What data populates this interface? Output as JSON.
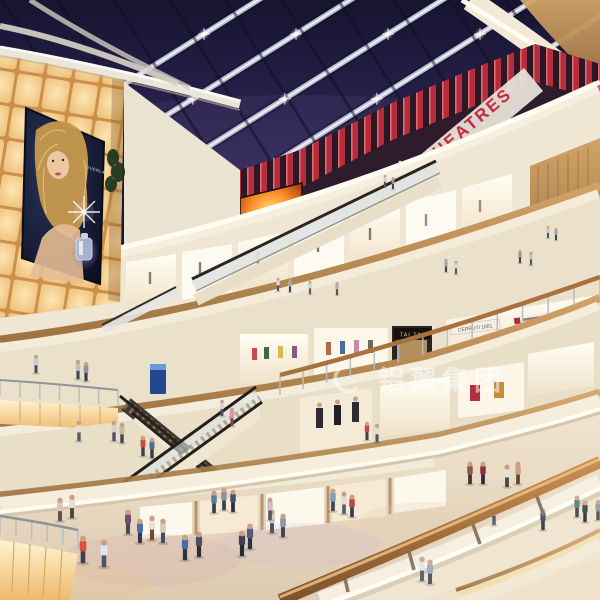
{
  "scene": {
    "description": "Night-time interior rendering of a multi-level shopping mall atrium with glass skylight, curved balconies, escalators and shoppers",
    "signs": {
      "theatres": "THEATRES",
      "tai_tai": "TAI TAI",
      "boutique": "CERRUTI 1881",
      "billboard_brand": "GUERLAIN"
    },
    "watermark": {
      "text": "铝翼集团"
    },
    "colors": {
      "sky": "#251f49",
      "beam": "#c9cde0",
      "red_slat": "#b5293a",
      "theatre_red": "#c4293c",
      "fascia_cream": "#f5eedd",
      "wood": "#c49a62",
      "glow_wall": "#f4cf92",
      "floor": "#e9dcc4",
      "fire_screen": "#ff8c2a",
      "rail_wood": "#b0793f",
      "watermark_white": "#ffffff"
    },
    "people": [
      [
        83,
        563,
        27,
        "#d9523f",
        "#3a3f55"
      ],
      [
        104,
        567,
        27,
        "#dfe6ee",
        "#4a5668"
      ],
      [
        128,
        534,
        24,
        "#7a4a6e",
        "#4a4a55"
      ],
      [
        140,
        543,
        24,
        "#4a6fae",
        "#333a4a"
      ],
      [
        152,
        540,
        24,
        "#e8e2d8",
        "#6b4a3a"
      ],
      [
        163,
        543,
        24,
        "#d8cfc2",
        "#3f4f66"
      ],
      [
        185,
        560,
        25,
        "#3f6fae",
        "#2c3342"
      ],
      [
        199,
        557,
        25,
        "#4a4f5e",
        "#2a2e3a"
      ],
      [
        214,
        513,
        22,
        "#5a7e9e",
        "#38404e"
      ],
      [
        224,
        510,
        22,
        "#8a93a5",
        "#3a3f4c"
      ],
      [
        233,
        512,
        22,
        "#46526b",
        "#2a3040"
      ],
      [
        242,
        556,
        25,
        "#3a4052",
        "#23283a"
      ],
      [
        250,
        549,
        25,
        "#555e72",
        "#2b3142"
      ],
      [
        272,
        533,
        23,
        "#c9d2dc",
        "#4a525f"
      ],
      [
        283,
        537,
        23,
        "#8f9aa8",
        "#3c4451"
      ],
      [
        270,
        520,
        22,
        "#d8b8c2",
        "#5a5560"
      ],
      [
        333,
        511,
        22,
        "#7aa2c4",
        "#3f4858"
      ],
      [
        344,
        514,
        22,
        "#e3dacd",
        "#56607a"
      ],
      [
        352,
        517,
        22,
        "#b04a50",
        "#3a3f50"
      ],
      [
        470,
        484,
        22,
        "#8a5a48",
        "#3a3530"
      ],
      [
        483,
        484,
        22,
        "#8f2f3a",
        "#2f2a33"
      ],
      [
        507,
        487,
        22,
        "#e5e0d6",
        "#4a4440"
      ],
      [
        518,
        484,
        22,
        "#c9a28a",
        "#5a4a3e"
      ],
      [
        543,
        530,
        21,
        "#3a3f4e",
        "#23283a"
      ],
      [
        577,
        517,
        21,
        "#4a7a6e",
        "#33363f"
      ],
      [
        585,
        522,
        21,
        "#2f3542",
        "#20242e"
      ],
      [
        598,
        520,
        20,
        "#8a93a0",
        "#3c424e"
      ],
      [
        494,
        525,
        21,
        "#b5bcc8",
        "#4a4f5c"
      ],
      [
        422,
        581,
        24,
        "#dfe4ea",
        "#4c5260"
      ],
      [
        430,
        584,
        24,
        "#9aa2b0",
        "#3c4250"
      ],
      [
        36,
        373,
        18,
        "#c9cfd8",
        "#4a4f5a"
      ],
      [
        78,
        379,
        19,
        "#b8c2cc",
        "#43495a"
      ],
      [
        86,
        381,
        19,
        "#8a94a2",
        "#39404e"
      ],
      [
        114,
        441,
        20,
        "#d8d2c6",
        "#4c5264"
      ],
      [
        122,
        443,
        20,
        "#c4b8a8",
        "#3f4656"
      ],
      [
        79,
        441,
        20,
        "#e2ded6",
        "#555b68"
      ],
      [
        143,
        456,
        20,
        "#cc4a42",
        "#3a4050"
      ],
      [
        152,
        458,
        20,
        "#4a6f9e",
        "#333a48"
      ],
      [
        60,
        521,
        23,
        "#d8cabb",
        "#5a5248"
      ],
      [
        72,
        518,
        23,
        "#e4ddd2",
        "#4a4540"
      ],
      [
        278,
        291,
        13,
        "#d8dde4",
        "#55565e"
      ],
      [
        290,
        292,
        13,
        "#aab4c0",
        "#44464e"
      ],
      [
        310,
        294,
        13,
        "#c8d0d8",
        "#555860"
      ],
      [
        337,
        295,
        13,
        "#b8a8b8",
        "#555"
      ],
      [
        446,
        272,
        13,
        "#9aa8b8",
        "#444"
      ],
      [
        456,
        274,
        13,
        "#cfd6de",
        "#555"
      ],
      [
        520,
        263,
        13,
        "#8a97a8",
        "#444"
      ],
      [
        531,
        265,
        13,
        "#bcc5d0",
        "#555"
      ],
      [
        548,
        238,
        12,
        "#c5cdd6",
        "#555"
      ],
      [
        556,
        240,
        12,
        "#99a4b2",
        "#444"
      ],
      [
        385,
        187,
        12,
        "#c9d2da",
        "#555"
      ],
      [
        393,
        189,
        12,
        "#8f99a8",
        "#444"
      ],
      [
        232,
        426,
        18,
        "#e88fb0",
        "#6b4a5a"
      ],
      [
        222,
        416,
        16,
        "#cfd6dd",
        "#4a5060"
      ],
      [
        367,
        440,
        18,
        "#c24a54",
        "#3a4050"
      ],
      [
        377,
        442,
        18,
        "#e2ddd2",
        "#4e5466"
      ]
    ]
  }
}
